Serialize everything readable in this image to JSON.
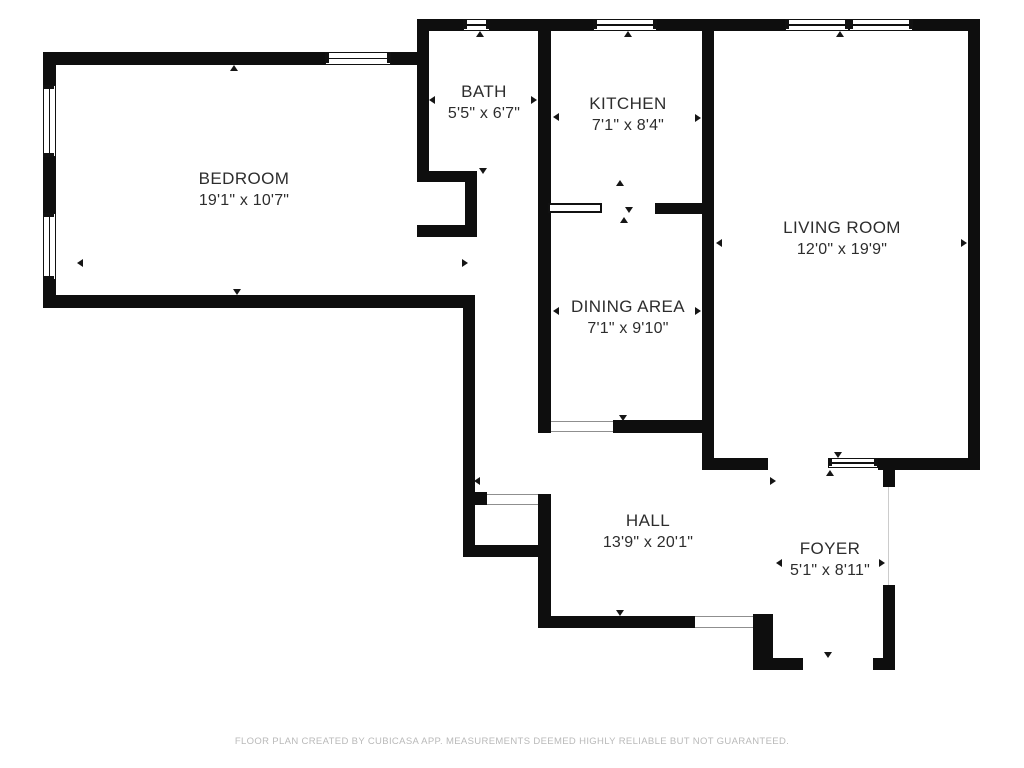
{
  "canvas": {
    "width": 1024,
    "height": 768,
    "background": "#ffffff"
  },
  "palette": {
    "wall": "#0e0e0e",
    "text": "#2d2d2d",
    "footer_text": "#b9b9b9",
    "threshold_line": "#8f8f8f",
    "hairline": "#cccccc"
  },
  "footer": {
    "disclaimer": "FLOOR PLAN CREATED BY CUBICASA APP. MEASUREMENTS DEEMED HIGHLY RELIABLE BUT NOT GUARANTEED."
  },
  "rooms": [
    {
      "id": "bedroom",
      "name": "BEDROOM",
      "dims": "19'1\" x 10'7\"",
      "cx": 244,
      "cy": 190
    },
    {
      "id": "bath",
      "name": "BATH",
      "dims": "5'5\" x 6'7\"",
      "cx": 484,
      "cy": 103
    },
    {
      "id": "kitchen",
      "name": "KITCHEN",
      "dims": "7'1\" x 8'4\"",
      "cx": 628,
      "cy": 115
    },
    {
      "id": "living-room",
      "name": "LIVING ROOM",
      "dims": "12'0\" x 19'9\"",
      "cx": 842,
      "cy": 239
    },
    {
      "id": "dining-area",
      "name": "DINING AREA",
      "dims": "7'1\" x 9'10\"",
      "cx": 628,
      "cy": 318
    },
    {
      "id": "hall",
      "name": "HALL",
      "dims": "13'9\" x 20'1\"",
      "cx": 648,
      "cy": 532
    },
    {
      "id": "foyer",
      "name": "FOYER",
      "dims": "5'1\" x 8'11\"",
      "cx": 830,
      "cy": 560
    }
  ],
  "walls": [
    [
      417,
      19,
      46,
      12
    ],
    [
      490,
      19,
      103,
      12
    ],
    [
      657,
      19,
      128,
      12
    ],
    [
      913,
      19,
      67,
      12
    ],
    [
      417,
      19,
      12,
      163
    ],
    [
      43,
      52,
      282,
      13
    ],
    [
      391,
      52,
      38,
      13
    ],
    [
      43,
      52,
      13,
      33
    ],
    [
      43,
      157,
      13,
      56
    ],
    [
      43,
      280,
      13,
      28
    ],
    [
      43,
      295,
      432,
      13
    ],
    [
      417,
      171,
      60,
      11
    ],
    [
      465,
      171,
      12,
      66
    ],
    [
      417,
      225,
      60,
      12
    ],
    [
      463,
      308,
      12,
      249
    ],
    [
      475,
      492,
      12,
      13
    ],
    [
      463,
      545,
      88,
      12
    ],
    [
      538,
      19,
      13,
      414
    ],
    [
      538,
      494,
      13,
      134
    ],
    [
      655,
      203,
      47,
      11
    ],
    [
      613,
      420,
      101,
      13
    ],
    [
      702,
      19,
      12,
      451
    ],
    [
      702,
      458,
      66,
      12
    ],
    [
      878,
      458,
      102,
      12
    ],
    [
      968,
      19,
      12,
      451
    ],
    [
      883,
      470,
      12,
      17
    ],
    [
      883,
      585,
      12,
      85
    ],
    [
      753,
      658,
      50,
      12
    ],
    [
      873,
      658,
      22,
      12
    ],
    [
      753,
      614,
      20,
      56
    ],
    [
      538,
      616,
      157,
      12
    ]
  ],
  "windows": [
    {
      "x": 463,
      "y": 19,
      "w": 27,
      "h": 12,
      "orient": "h"
    },
    {
      "x": 593,
      "y": 19,
      "w": 64,
      "h": 12,
      "orient": "h"
    },
    {
      "x": 785,
      "y": 19,
      "w": 64,
      "h": 12,
      "orient": "h"
    },
    {
      "x": 849,
      "y": 19,
      "w": 64,
      "h": 12,
      "orient": "h"
    },
    {
      "x": 325,
      "y": 52,
      "w": 66,
      "h": 13,
      "orient": "h"
    },
    {
      "x": 43,
      "y": 85,
      "w": 13,
      "h": 72,
      "orient": "v"
    },
    {
      "x": 43,
      "y": 213,
      "w": 13,
      "h": 67,
      "orient": "v"
    },
    {
      "x": 828,
      "y": 458,
      "w": 50,
      "h": 10,
      "orient": "h"
    }
  ],
  "thresholds": [
    {
      "x": 551,
      "y": 421,
      "w": 62,
      "h": 11
    },
    {
      "x": 487,
      "y": 494,
      "w": 51,
      "h": 11
    },
    {
      "x": 695,
      "y": 616,
      "w": 58,
      "h": 12
    }
  ],
  "hairlines": [
    {
      "x": 888,
      "y": 487,
      "w": 1,
      "h": 98
    }
  ],
  "counter": {
    "x": 548,
    "y": 203,
    "w": 54,
    "h": 10
  },
  "arrows": [
    {
      "x": 234,
      "y": 65,
      "dir": "up"
    },
    {
      "x": 237,
      "y": 295,
      "dir": "down"
    },
    {
      "x": 77,
      "y": 263,
      "dir": "left"
    },
    {
      "x": 480,
      "y": 31,
      "dir": "up"
    },
    {
      "x": 429,
      "y": 100,
      "dir": "left"
    },
    {
      "x": 537,
      "y": 100,
      "dir": "right"
    },
    {
      "x": 483,
      "y": 174,
      "dir": "down"
    },
    {
      "x": 628,
      "y": 31,
      "dir": "up"
    },
    {
      "x": 553,
      "y": 117,
      "dir": "left"
    },
    {
      "x": 701,
      "y": 118,
      "dir": "right"
    },
    {
      "x": 620,
      "y": 180,
      "dir": "up"
    },
    {
      "x": 629,
      "y": 213,
      "dir": "down"
    },
    {
      "x": 624,
      "y": 217,
      "dir": "up"
    },
    {
      "x": 553,
      "y": 311,
      "dir": "left"
    },
    {
      "x": 701,
      "y": 311,
      "dir": "right"
    },
    {
      "x": 623,
      "y": 421,
      "dir": "down"
    },
    {
      "x": 840,
      "y": 31,
      "dir": "up"
    },
    {
      "x": 716,
      "y": 243,
      "dir": "left"
    },
    {
      "x": 967,
      "y": 243,
      "dir": "right"
    },
    {
      "x": 838,
      "y": 458,
      "dir": "down"
    },
    {
      "x": 830,
      "y": 470,
      "dir": "up"
    },
    {
      "x": 776,
      "y": 481,
      "dir": "right"
    },
    {
      "x": 620,
      "y": 616,
      "dir": "down"
    },
    {
      "x": 474,
      "y": 481,
      "dir": "left"
    },
    {
      "x": 468,
      "y": 263,
      "dir": "right"
    },
    {
      "x": 776,
      "y": 563,
      "dir": "left"
    },
    {
      "x": 885,
      "y": 563,
      "dir": "right"
    },
    {
      "x": 828,
      "y": 658,
      "dir": "down"
    }
  ]
}
